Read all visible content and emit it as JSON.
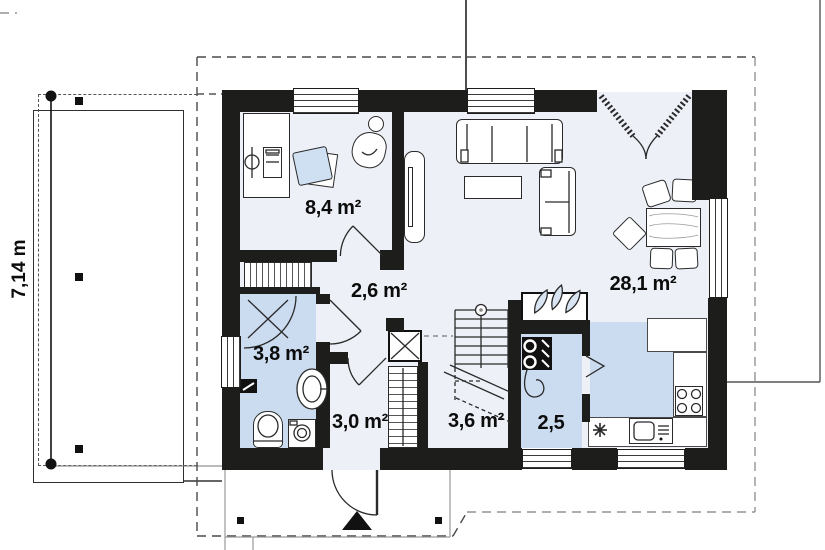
{
  "title": "house-ground-floor-plan",
  "dimension_label": "7,14 m",
  "rooms": [
    {
      "name": "office",
      "area_label": "8,4 m²"
    },
    {
      "name": "hall",
      "area_label": "2,6 m²"
    },
    {
      "name": "living-room-kitchen",
      "area_label": "28,1 m²"
    },
    {
      "name": "bathroom",
      "area_label": "3,8 m²"
    },
    {
      "name": "entrance-hall",
      "area_label": "3,0 m²"
    },
    {
      "name": "staircase",
      "area_label": "3,6 m²"
    },
    {
      "name": "utility-room",
      "area_label": "2,5"
    }
  ],
  "colors": {
    "wall": "#1d1d1b",
    "floor": "#edf1f7",
    "wet_room_floor": "#cbdcf0",
    "furniture_fill": "#ffffff",
    "chair_fill": "#cfe0f3",
    "dashed_outline": "#555555"
  }
}
